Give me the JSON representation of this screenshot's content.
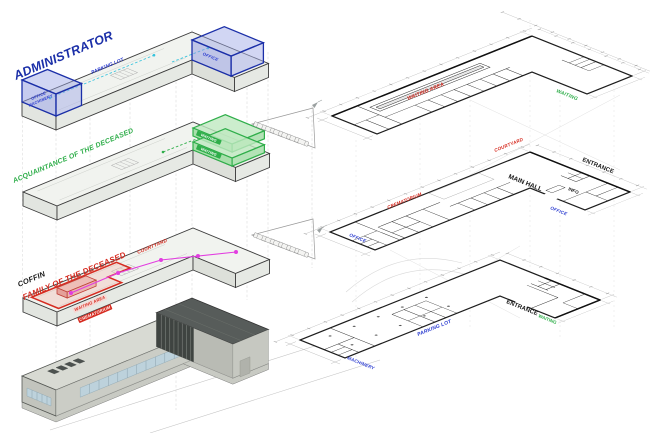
{
  "colors": {
    "administrator": "#1b2fa8",
    "acquaintance": "#2fae4a",
    "family": "#d62b20",
    "black": "#1a1a1a",
    "blue_label": "#2a3bd0",
    "green_label": "#2fae4a",
    "magenta": "#e23de0",
    "cyan": "#35c3dd"
  },
  "stack": {
    "levels": [
      {
        "name": "administrator-level",
        "title": "ADMINISTRATOR",
        "labels": {
          "parking_lot": "PARKING LOT",
          "office_box_line1": "OFFICE",
          "office_box_line2": "MACHINERY",
          "office_right": "OFFICE"
        }
      },
      {
        "name": "acquaintance-level",
        "title": "ACQUAINTANCE OF THE DECEASED",
        "labels": {
          "waiting_upper": "WAITING",
          "waiting_lower": "WAITING"
        }
      },
      {
        "name": "family-level",
        "title_coffin": "COFFIN",
        "title": "FAMILY OF THE DECEASED",
        "labels": {
          "courtyard": "COURTYARD",
          "waiting_area": "WAITING AREA",
          "crematorium": "CREMATORIUM"
        }
      },
      {
        "name": "building-render"
      }
    ]
  },
  "plans": [
    {
      "name": "second-floor-plan",
      "labels": {
        "waiting_area": "WAITING AREA",
        "waiting": "WAITING"
      }
    },
    {
      "name": "first-floor-plan",
      "labels": {
        "courtyard": "COURTYARD",
        "crematorium": "CREMATORIUM",
        "main_hall": "MAIN HALL",
        "entrance": "ENTRANCE",
        "info": "INFO",
        "office_wing": "OFFICE",
        "office_end": "OFFICE"
      }
    },
    {
      "name": "ground-floor-plan",
      "labels": {
        "parking_lot": "PARKING LOT",
        "machinery": "MACHINERY",
        "entrance": "ENTRANCE",
        "waiting": "WAITING"
      }
    }
  ]
}
